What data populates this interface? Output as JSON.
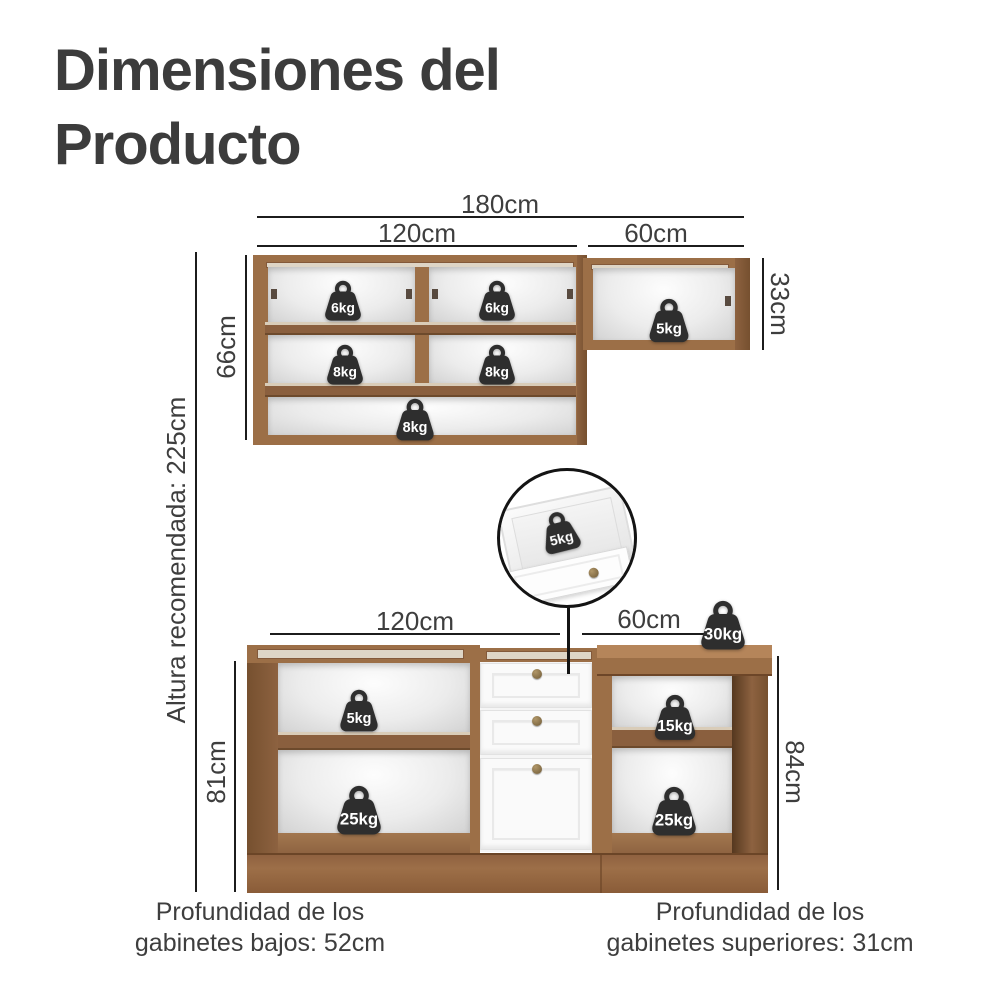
{
  "title": {
    "lines": [
      "Dimensiones del",
      "Producto"
    ]
  },
  "recommended_height": "Altura recomendada: 225cm",
  "upper_section": {
    "width_total": "180cm",
    "width_left": "120cm",
    "width_right": "60cm",
    "height_left": "66cm",
    "height_right": "33cm",
    "weights": {
      "shelf_top_left": "6kg",
      "shelf_top_right": "6kg",
      "shelf_mid_left": "8kg",
      "shelf_mid_right": "8kg",
      "shelf_bottom": "8kg",
      "right_cabinet": "5kg"
    }
  },
  "inset": {
    "drawer_weight": "5kg"
  },
  "lower_section": {
    "width_left": "120cm",
    "width_right": "60cm",
    "height_left": "81cm",
    "height_right": "84cm",
    "countertop_weight": "30kg",
    "weights": {
      "left_top": "5kg",
      "left_bottom": "25kg",
      "right_top": "15kg",
      "right_bottom": "25kg"
    }
  },
  "captions": {
    "left": [
      "Profundidad de los",
      "gabinetes bajos: 52cm"
    ],
    "right": [
      "Profundidad de los",
      "gabinetes superiores: 31cm"
    ]
  },
  "icons": {
    "weight": "weight-icon"
  },
  "colors": {
    "text": "#3e3e3e",
    "line": "#1c1c1c",
    "wood": "#9c6f47",
    "wood_light": "#b5855a",
    "wood_dark": "#7a5232",
    "weight_fill": "#2e2e2e"
  }
}
